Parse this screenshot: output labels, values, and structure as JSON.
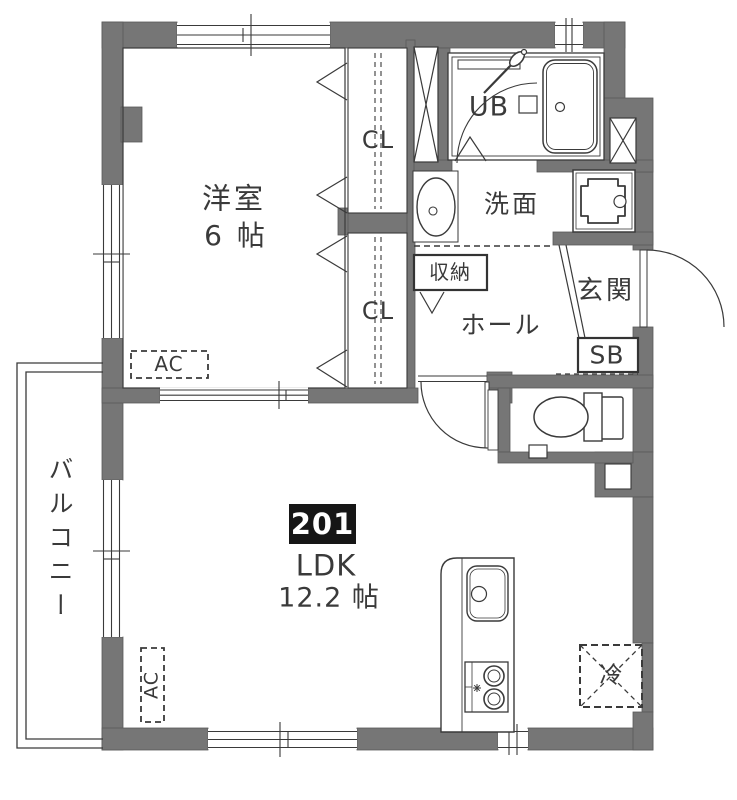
{
  "unit": {
    "number": "201"
  },
  "rooms": {
    "western": {
      "label": "洋室",
      "size": "6 帖"
    },
    "ldk": {
      "badge": "201",
      "label": "LDK",
      "size": "12.2 帖"
    },
    "closet_upper": {
      "label": "CL"
    },
    "closet_lower": {
      "label": "CL"
    },
    "unit_bath": {
      "label": "UB"
    },
    "washroom": {
      "label": "洗面"
    },
    "storage": {
      "label": "収納"
    },
    "hall": {
      "label": "ホール"
    },
    "entrance": {
      "label": "玄関"
    },
    "shoe_box": {
      "label": "SB"
    },
    "balcony": {
      "label": "バルコニー"
    }
  },
  "fixtures": {
    "ac_western": {
      "label": "AC"
    },
    "ac_ldk": {
      "label": "AC"
    },
    "refrigerator": {
      "label": "冷"
    }
  },
  "colors": {
    "wall": "#767676",
    "line": "#3a3a3a",
    "badge_bg": "#161616",
    "badge_text": "#ffffff",
    "background": "#ffffff"
  }
}
